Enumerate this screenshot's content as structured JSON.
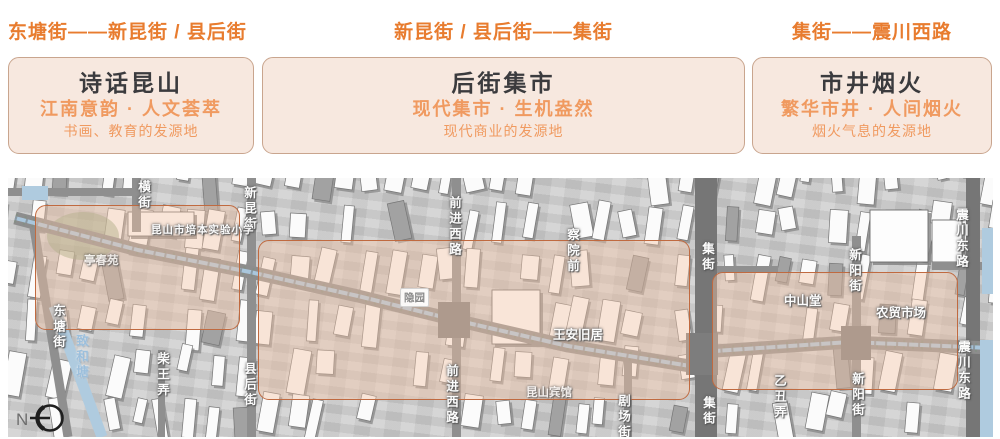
{
  "colors": {
    "accent": "#e87c2f",
    "sub_accent": "#f09a60",
    "card_bg": "#f7e8df",
    "card_border": "#c9a58e",
    "title_text": "#3b3b3e",
    "zone_fill": "rgba(243,196,165,0.42)",
    "zone_border": "#c06a40",
    "map_bg": "#cbcbcb",
    "road": "#8f8f8f",
    "road_dark": "#767676",
    "water": "#afcbdf",
    "green": "#8aa37c"
  },
  "sections": [
    {
      "range": "东塘街——新昆街 / 县后街",
      "title": "诗话昆山",
      "subtitle": "江南意韵 · 人文荟萃",
      "desc": "书画、教育的发源地"
    },
    {
      "range": "新昆街 / 县后街——集街",
      "title": "后街集市",
      "subtitle": "现代集市 · 生机盎然",
      "desc": "现代商业的发源地"
    },
    {
      "range": "集街——震川西路",
      "title": "市井烟火",
      "subtitle": "繁华市井 · 人间烟火",
      "desc": "烟火气息的发源地"
    }
  ],
  "map": {
    "compass_label": "N",
    "zones": [
      {
        "x": 27,
        "y": 27,
        "w": 205,
        "h": 125
      },
      {
        "x": 250,
        "y": 62,
        "w": 432,
        "h": 160
      },
      {
        "x": 704,
        "y": 94,
        "w": 246,
        "h": 118
      }
    ],
    "labels": [
      {
        "text": "横街",
        "x": 126,
        "y": 2,
        "kind": "street-v"
      },
      {
        "text": "新昆街",
        "x": 232,
        "y": 8,
        "kind": "street-v"
      },
      {
        "text": "昆山市培本实验小学",
        "x": 143,
        "y": 44,
        "kind": "street-h-small"
      },
      {
        "text": "亭春苑",
        "x": 76,
        "y": 74,
        "kind": "poi-faint"
      },
      {
        "text": "东塘街",
        "x": 41,
        "y": 126,
        "kind": "street-v"
      },
      {
        "text": "致和塘",
        "x": 64,
        "y": 156,
        "kind": "water-v"
      },
      {
        "text": "柴王弄",
        "x": 145,
        "y": 174,
        "kind": "street-v"
      },
      {
        "text": "县后街",
        "x": 232,
        "y": 184,
        "kind": "street-v"
      },
      {
        "text": "前进西路",
        "x": 437,
        "y": 18,
        "kind": "street-v"
      },
      {
        "text": "隐园",
        "x": 392,
        "y": 110,
        "kind": "poi-box"
      },
      {
        "text": "前进西路",
        "x": 434,
        "y": 186,
        "kind": "street-v"
      },
      {
        "text": "察院前",
        "x": 555,
        "y": 50,
        "kind": "street-v"
      },
      {
        "text": "集街",
        "x": 690,
        "y": 64,
        "kind": "street-v"
      },
      {
        "text": "王安旧居",
        "x": 545,
        "y": 146,
        "kind": "poi"
      },
      {
        "text": "昆山宾馆",
        "x": 518,
        "y": 206,
        "kind": "poi-faint"
      },
      {
        "text": "剧场街",
        "x": 606,
        "y": 216,
        "kind": "street-v"
      },
      {
        "text": "集街",
        "x": 691,
        "y": 218,
        "kind": "street-v"
      },
      {
        "text": "新阳街",
        "x": 837,
        "y": 70,
        "kind": "street-v"
      },
      {
        "text": "震川东路",
        "x": 944,
        "y": 30,
        "kind": "street-v"
      },
      {
        "text": "中山堂",
        "x": 776,
        "y": 112,
        "kind": "poi"
      },
      {
        "text": "农贸市场",
        "x": 868,
        "y": 124,
        "kind": "poi"
      },
      {
        "text": "乙丑弄",
        "x": 762,
        "y": 196,
        "kind": "street-v"
      },
      {
        "text": "新阳街",
        "x": 840,
        "y": 194,
        "kind": "street-v"
      },
      {
        "text": "震川东路",
        "x": 946,
        "y": 162,
        "kind": "street-v"
      }
    ],
    "roads": {
      "vertical": [
        [
          124,
          0,
          9,
          54
        ],
        [
          239,
          0,
          9,
          259
        ],
        [
          150,
          172,
          7,
          87
        ],
        [
          444,
          0,
          9,
          259
        ],
        [
          616,
          182,
          8,
          77
        ],
        [
          687,
          0,
          22,
          259
        ],
        [
          844,
          58,
          9,
          201
        ],
        [
          958,
          0,
          14,
          259
        ]
      ],
      "horizontal": [
        [
          0,
          10,
          128,
          8
        ],
        [
          692,
          88,
          78,
          7
        ],
        [
          924,
          84,
          68,
          8
        ]
      ],
      "diagonal": [
        [
          26,
          50,
          60,
          259,
          9
        ]
      ],
      "canal_road": "7,40 130,72 242,94 350,118 447,142 560,168 682,188 707,173 842,164 982,170",
      "blobs": [
        [
          430,
          124,
          32,
          36
        ],
        [
          678,
          155,
          32,
          42
        ],
        [
          833,
          148,
          30,
          34
        ]
      ]
    },
    "water": {
      "zhihetang": [
        46,
        128,
        94,
        259,
        11
      ],
      "strips": [
        [
          974,
          50,
          16,
          66
        ],
        [
          972,
          162,
          18,
          97
        ],
        [
          14,
          8,
          26,
          14
        ]
      ]
    },
    "green": [
      75,
      58,
      36,
      24
    ],
    "big_buildings": [
      [
        862,
        32,
        58,
        52
      ],
      [
        924,
        42,
        30,
        42
      ],
      [
        484,
        112,
        48,
        54
      ],
      [
        120,
        34,
        66,
        24
      ]
    ]
  }
}
